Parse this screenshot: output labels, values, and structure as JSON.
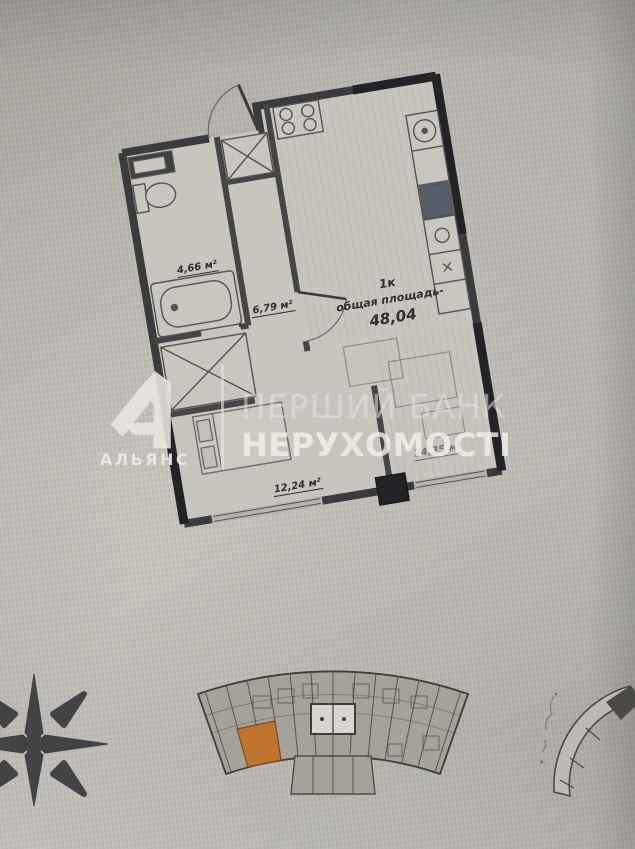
{
  "apartment": {
    "type": "1к",
    "total_label": "общая площадь-",
    "total_value": "48,04",
    "rooms": {
      "bathroom": {
        "area": "4,66 м²"
      },
      "hallway": {
        "area": "6,79 м²"
      },
      "bedroom": {
        "area": "12,24 м²"
      },
      "kitchen_living": {
        "area": "24,35 м²"
      }
    }
  },
  "watermark": {
    "brand": "АЛЬЯНС",
    "line1": "ПЕРШИЙ БАНК",
    "line2": "НЕРУХОМОСТІ"
  },
  "colors": {
    "highlighted_unit": "#c0752f",
    "walls": "#3b3a3c",
    "dark_piers": "#232327",
    "paper": "#c2bfb8",
    "watermark_text": "#e9e7e1"
  }
}
